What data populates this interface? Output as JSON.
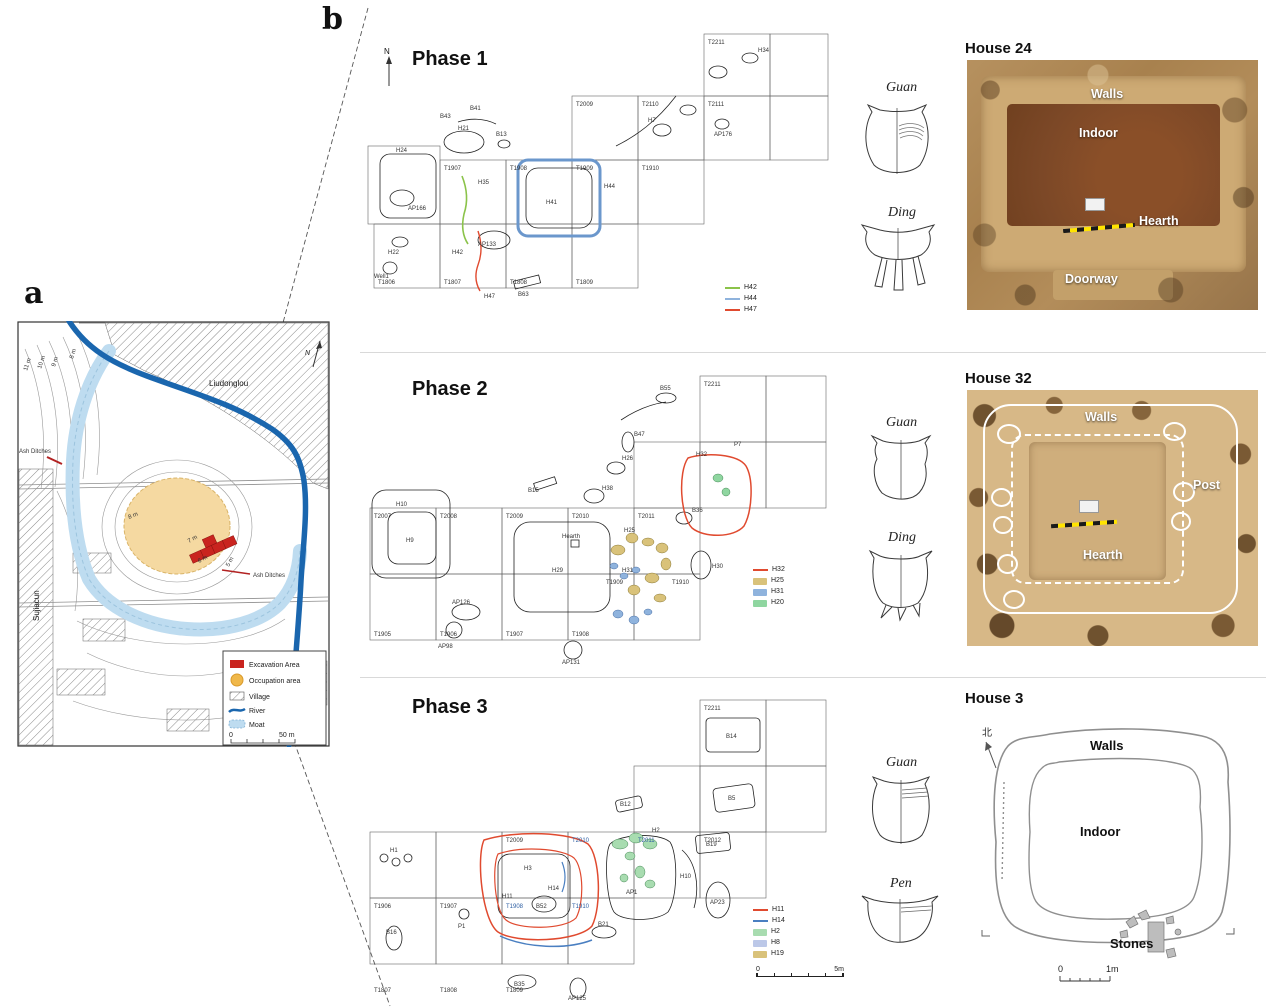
{
  "panel_a": {
    "label": "a",
    "north_label": "N",
    "liudonglou": "Liudonglou",
    "sujiacun": "Sujiacun",
    "ash_ditches_left": "Ash Ditches",
    "ash_ditches_right": "Ash Ditches",
    "contours": [
      "11 m",
      "10 m",
      "9 m",
      "8 m",
      "8 m",
      "7 m",
      "6 m",
      "5 m"
    ],
    "legend": {
      "excavation": "Excavation Area",
      "occupation": "Occupation area",
      "village": "Village",
      "river": "River",
      "moat": "Moat",
      "scale_zero": "0",
      "scale_max": "50 m"
    },
    "colors": {
      "river": "#1a66ae",
      "moat": "#bedcf0",
      "occupation": "#f5d9a1",
      "excavation": "#c9241f"
    }
  },
  "panel_b": {
    "label": "b"
  },
  "phases": [
    {
      "title": "Phase 1",
      "north_label": "N",
      "legend": [
        {
          "label": "H42",
          "color": "#8bc34a",
          "swatch": "line"
        },
        {
          "label": "H44",
          "color": "#8fb3dd",
          "swatch": "line"
        },
        {
          "label": "H47",
          "color": "#e04a2f",
          "swatch": "line"
        }
      ],
      "pottery": [
        {
          "name": "Guan"
        },
        {
          "name": "Ding"
        }
      ],
      "house": {
        "title": "House 24",
        "walls": "Walls",
        "indoor": "Indoor",
        "hearth": "Hearth",
        "doorway": "Doorway"
      },
      "grid_labels": [
        "T1806",
        "T1807",
        "T1808",
        "T1809",
        "T1907",
        "T1908",
        "T1909",
        "T1910",
        "T2009",
        "T2110",
        "T2111",
        "T2211"
      ],
      "feature_labels": [
        "H24",
        "H21",
        "H22",
        "H35",
        "H42",
        "H41",
        "H44",
        "H47",
        "H7",
        "H34",
        "B43",
        "B41",
        "B13",
        "AP166",
        "AP176",
        "AP133",
        "Well1",
        "B63"
      ]
    },
    {
      "title": "Phase 2",
      "legend": [
        {
          "label": "H32",
          "color": "#e04a2f",
          "swatch": "line"
        },
        {
          "label": "H25",
          "color": "#d9c27a",
          "swatch": "fill"
        },
        {
          "label": "H31",
          "color": "#8fb3dd",
          "swatch": "fill"
        },
        {
          "label": "H20",
          "color": "#8fd6a0",
          "swatch": "fill"
        }
      ],
      "pottery": [
        {
          "name": "Guan"
        },
        {
          "name": "Ding"
        }
      ],
      "house": {
        "title": "House 32",
        "walls": "Walls",
        "post": "Post",
        "hearth": "Hearth"
      },
      "grid_labels": [
        "T1905",
        "T1906",
        "T1907",
        "T1908",
        "T1909",
        "T1910",
        "T2007",
        "T2008",
        "T2009",
        "T2010",
        "T2011",
        "T2211"
      ],
      "feature_labels": [
        "H10",
        "H9",
        "H29",
        "Hearth",
        "H32",
        "H25",
        "H31",
        "H30",
        "H38",
        "H26",
        "B47",
        "B55",
        "B15",
        "B36",
        "AP126",
        "AP131",
        "AP98",
        "P7"
      ]
    },
    {
      "title": "Phase 3",
      "legend": [
        {
          "label": "H11",
          "color": "#e04a2f",
          "swatch": "line"
        },
        {
          "label": "H14",
          "color": "#4a7fc1",
          "swatch": "line"
        },
        {
          "label": "H2",
          "color": "#a8dcb0",
          "swatch": "fill"
        },
        {
          "label": "H8",
          "color": "#bcc8e8",
          "swatch": "fill"
        },
        {
          "label": "H19",
          "color": "#d9c27a",
          "swatch": "fill"
        }
      ],
      "scale": {
        "zero": "0",
        "max": "5m"
      },
      "pottery": [
        {
          "name": "Guan"
        },
        {
          "name": "Pen"
        }
      ],
      "house": {
        "title": "House 3",
        "walls": "Walls",
        "indoor": "Indoor",
        "stones": "Stones",
        "north_char": "北",
        "scale_zero": "0",
        "scale_max": "1m"
      },
      "grid_labels": [
        "T1807",
        "T1808",
        "T1809",
        "T1906",
        "T1907",
        "T1908",
        "T1910",
        "T2009",
        "T2010",
        "T2011",
        "T2012",
        "T2211"
      ],
      "feature_labels": [
        "H1",
        "H3",
        "H11",
        "H14",
        "B52",
        "H2",
        "AP1",
        "H10",
        "AP23",
        "B21",
        "B14",
        "B5",
        "B19",
        "B12",
        "B16",
        "B35",
        "AP125",
        "P1"
      ]
    }
  ]
}
